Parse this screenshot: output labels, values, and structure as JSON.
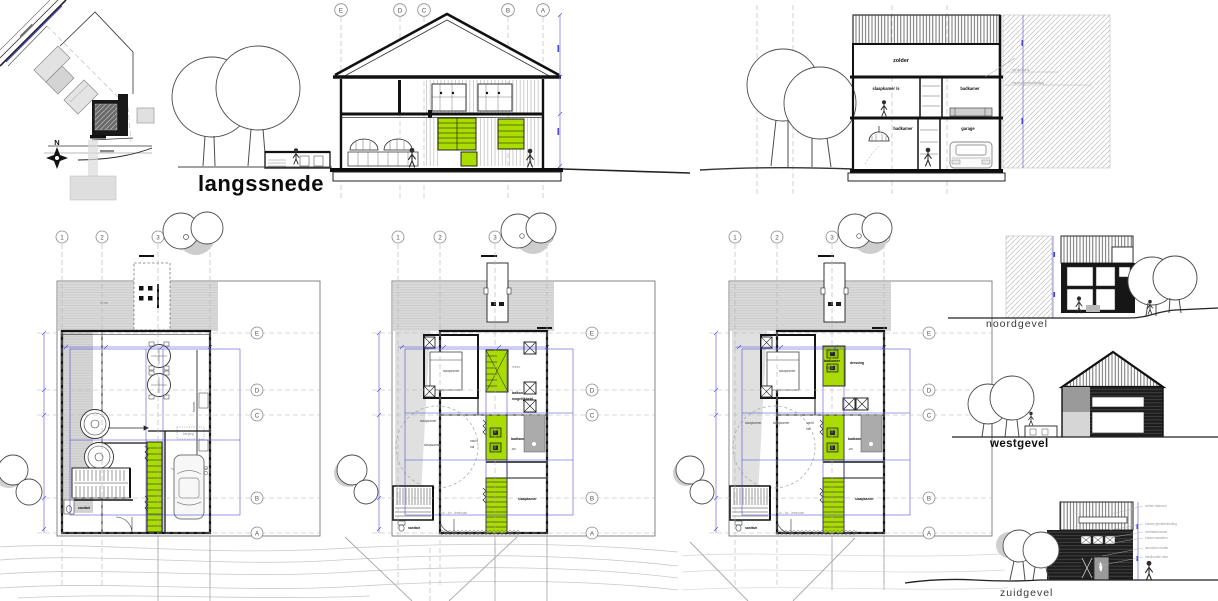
{
  "colors": {
    "accent_green": "#abdc00",
    "dim_blue": "#4646d2",
    "dark": "#161616",
    "gray_fill": "#d9d9d9"
  },
  "site_plan": {
    "north_label": "N"
  },
  "section_long": {
    "title": "langssnede",
    "grid_letters": [
      "E",
      "D",
      "C",
      "B",
      "A"
    ]
  },
  "section_cross": {
    "room_attic": "zolder",
    "room_bedroom": "slaapkamer /s",
    "room_bath_upper": "badkamer",
    "room_bath_lower": "badkamer",
    "room_garage": "garage",
    "annotation_1": "wit stucwerk",
    "annotation_2": "houten gevelbekleding"
  },
  "plans": [
    {
      "grid_columns": [
        "1",
        "2",
        "3",
        "4"
      ],
      "grid_rows": [
        "E",
        "D",
        "C",
        "B",
        "A"
      ],
      "room_terras": "terras",
      "room_keuken": "keuken",
      "room_berging": "berging",
      "room_hal": "hal",
      "room_garage": "garage",
      "room_sanitair": "sanitair"
    },
    {
      "grid_columns": [
        "1",
        "2",
        "3",
        "4"
      ],
      "grid_rows": [
        "E",
        "D",
        "C",
        "B",
        "A"
      ],
      "room_slaapkamer_1": "slaapkamer",
      "room_dress": "dress.",
      "note_line_1": "balkon",
      "note_line_2": "mogelijkheid",
      "room_slaapkamer_2": "slaapkamer",
      "room_slaapkamer_3": "slaapkamer",
      "room_nacht": "nacht",
      "room_hal": "hal",
      "room_badkamer": "badkamer",
      "room_wc": "-wc",
      "room_slaapkamer_4": "slaapkamer",
      "room_leeshoek": "b.b. - bc - leeshoek",
      "room_sanitair": "sanitair"
    },
    {
      "grid_columns": [
        "1",
        "2",
        "3",
        "4"
      ],
      "grid_rows": [
        "E",
        "D",
        "C",
        "B",
        "A"
      ],
      "room_slaapkamer_1": "slaapkamer",
      "room_badkamer_1": "badkamer",
      "room_bad": "bad",
      "room_dressing": "dressing",
      "room_slaapkamer_2": "slaapkamer",
      "room_slaapkamer_3": "slaapkamer",
      "room_nacht": "nacht",
      "room_hal": "hal",
      "room_badkamer_2": "badkamer",
      "room_wc": "-wc",
      "room_slaapkamer_4": "slaapkamer",
      "room_leeshoek": "b.b. - bc - leeshoek",
      "room_sanitair": "sanitair"
    }
  ],
  "elevations": {
    "north": {
      "title": "noordgevel"
    },
    "west": {
      "title": "westgevel"
    },
    "south": {
      "title": "zuidgevel",
      "annotations": [
        "zinken dakrand",
        "houten gevelbekleding",
        "ventilatierooster",
        "houten lamellen",
        "aluminium kader",
        "hardhouten deur"
      ]
    }
  }
}
